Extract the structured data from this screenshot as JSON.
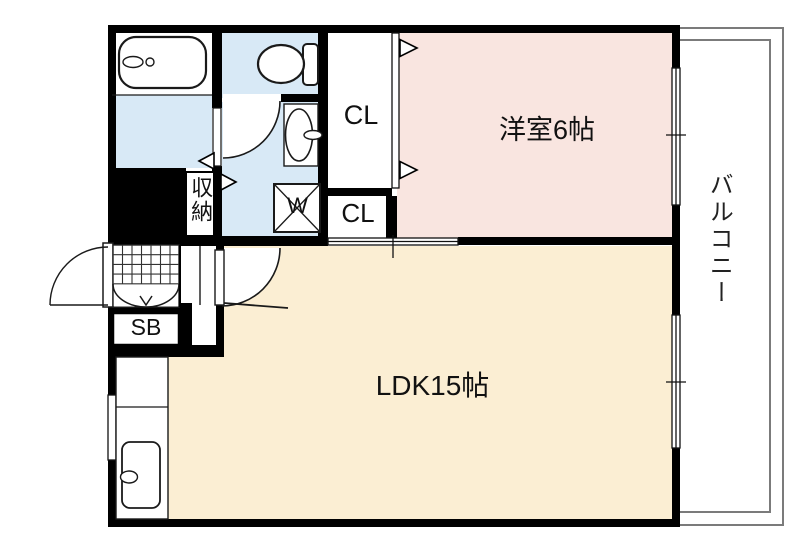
{
  "floorplan": {
    "rooms": {
      "western_room": {
        "label": "洋室6帖"
      },
      "ldk": {
        "label": "LDK15帖"
      },
      "balcony": {
        "label": "バルコニー"
      },
      "closet_upper": {
        "label": "CL"
      },
      "closet_lower": {
        "label": "CL"
      },
      "storage": {
        "label": "収納"
      },
      "washing_machine_pan": {
        "label": "W"
      },
      "shoe_box": {
        "label": "SB"
      }
    },
    "colors": {
      "western_room_pink": "#f9e5e0",
      "ldk_cream": "#fbeed3",
      "wet_area_blue": "#d8e9f6",
      "wall_black": "#000000",
      "balcony_outline_gray": "#7b7b7b"
    }
  }
}
